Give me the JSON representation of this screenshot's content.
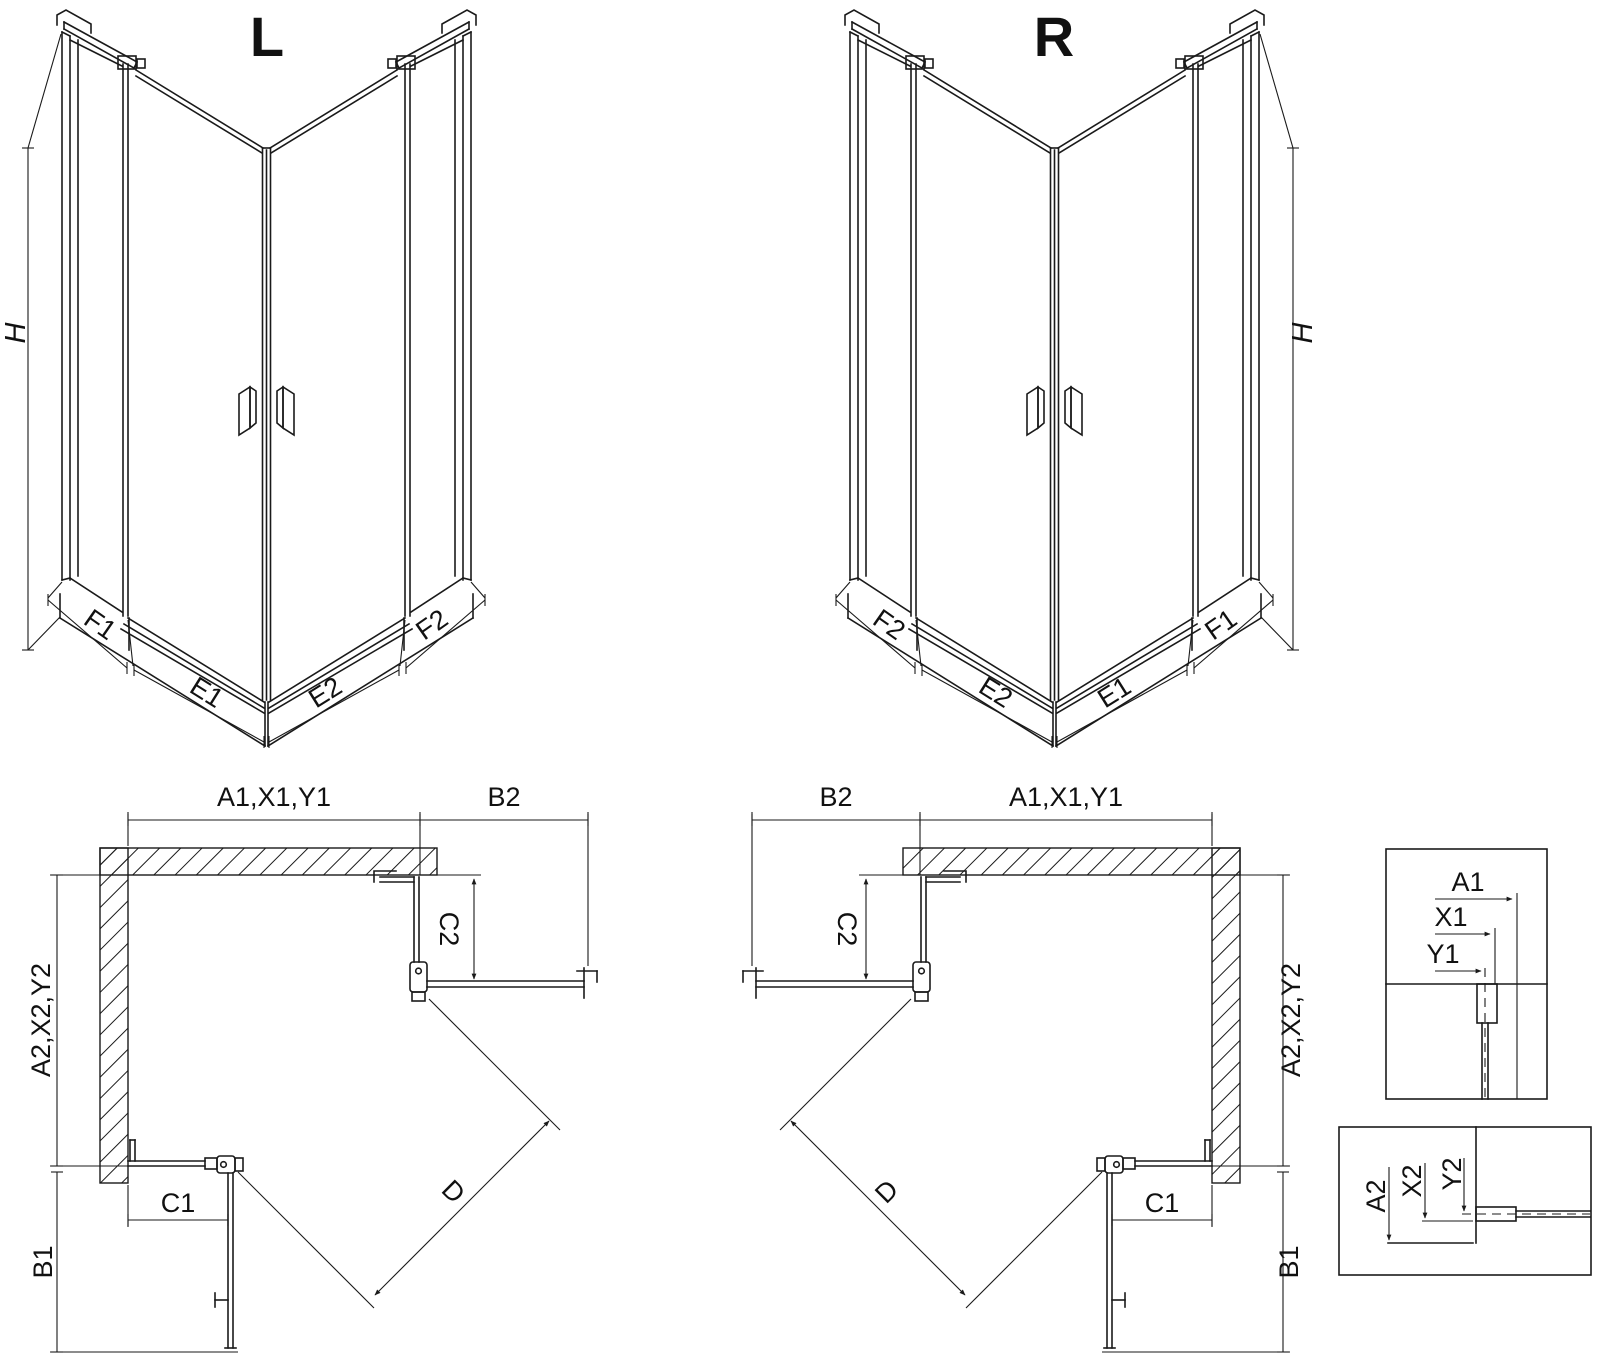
{
  "colors": {
    "line": "#1a1a1a",
    "text": "#111111",
    "background": "#ffffff"
  },
  "figures": {
    "iso_left": {
      "title": "L",
      "height_label": "H",
      "bottom_labels": {
        "f1": "F1",
        "e1": "E1",
        "e2": "E2",
        "f2": "F2"
      }
    },
    "iso_right": {
      "title": "R",
      "height_label": "H",
      "bottom_labels": {
        "f2": "F2",
        "e2": "E2",
        "e1": "E1",
        "f1": "F1"
      }
    },
    "plan_left": {
      "top_width": "A1,X1,Y1",
      "top_right_width": "B2",
      "right_depth": "C2",
      "left_depth": "A2,X2,Y2",
      "bottom_width": "C1",
      "bottom_left_depth": "B1",
      "diagonal": "D"
    },
    "plan_right": {
      "top_left_width": "B2",
      "top_width": "A1,X1,Y1",
      "left_depth": "C2",
      "right_depth": "A2,X2,Y2",
      "bottom_width": "C1",
      "bottom_right_depth": "B1",
      "diagonal": "D"
    },
    "detail_top": {
      "labels": {
        "a1": "A1",
        "x1": "X1",
        "y1": "Y1"
      }
    },
    "detail_bottom": {
      "labels": {
        "a2": "A2",
        "x2": "X2",
        "y2": "Y2"
      }
    }
  }
}
